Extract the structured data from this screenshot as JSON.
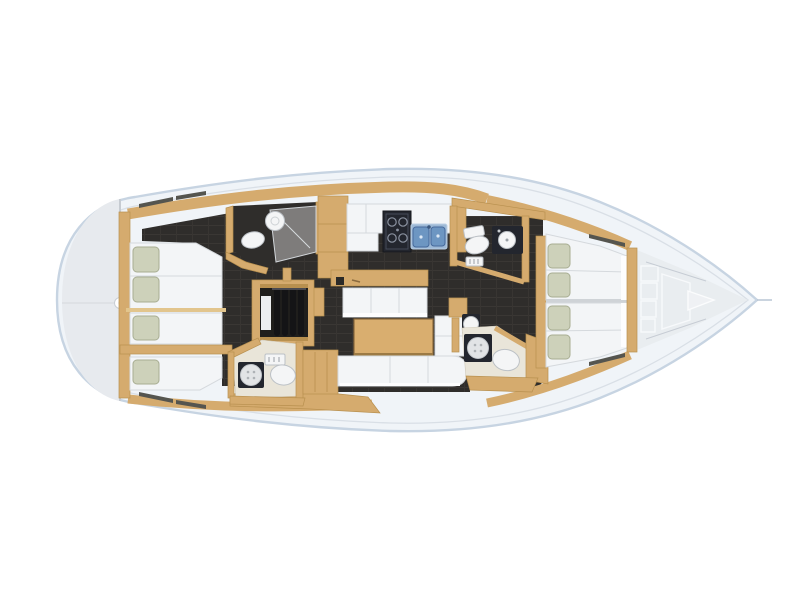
{
  "image": {
    "kind": "sailing-yacht-interior-layout-plan",
    "view": "top-down",
    "bow_direction": "right",
    "stern_direction": "left"
  },
  "colors": {
    "background": "#ffffff",
    "hull_fill": "#f0f4f8",
    "hull_edge": "#c7d4e2",
    "deck_line": "#d9dfe6",
    "transom": "#e7eaee",
    "wood": "#d5ab6e",
    "wood_dark": "#b8904f",
    "wood_light": "#e2c58d",
    "sole_dark": "#2f2d2b",
    "sole_line": "#3a3734",
    "furniture_white": "#f3f5f7",
    "furniture_edge": "#d5d9dd",
    "pillow": "#cdd1ba",
    "pillow_edge": "#a8ad92",
    "sink_blue": "#6d96c2",
    "sink_blue_dark": "#46699c",
    "stove_dark": "#23262e",
    "fixture_white": "#f4f5f6",
    "fixture_edge": "#bcc1c6",
    "shower_gray": "#e2e4e6",
    "head_floor_cream": "#e9e5d9",
    "forepeak": "#e9edf0",
    "hatch_dark": "#55554f"
  },
  "areas": {
    "hull": "hull",
    "transom": "transom-swim-platform",
    "aft_cabin_port": "aft-cabin-port-berth",
    "aft_berth_middle": "aft-berth-middle",
    "aft_cabin_starboard": "aft-cabin-starboard-berth",
    "head_aft_port": "aft-port-head",
    "head_aft_starboard": "aft-starboard-head",
    "stairs": "companionway-stairs",
    "wardrobe": "wardrobe-lockers",
    "galley": "galley",
    "stove": "stove",
    "sink": "double-sink",
    "bench": "saloon-bench",
    "table": "saloon-table",
    "settee": "saloon-settee",
    "head_fwd_port": "forward-port-head",
    "head_fwd_starboard": "forward-starboard-head",
    "fwd_cabin_port": "forward-cabin-port-berth",
    "fwd_cabin_starboard": "forward-cabin-starboard-berth",
    "forepeak": "forepeak-sail-locker",
    "mast": "mast-step",
    "hatches": "deck-hatches"
  }
}
